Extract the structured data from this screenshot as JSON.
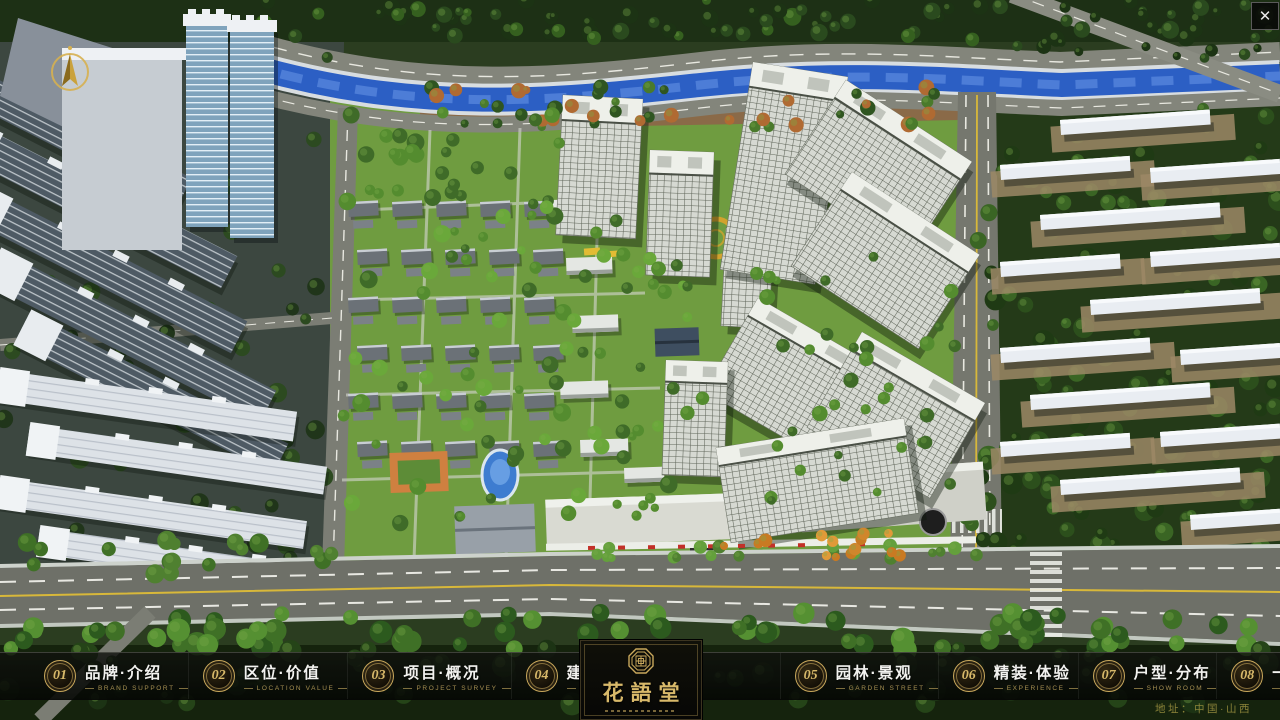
{
  "app": {
    "close_button": "✕"
  },
  "viewport": {
    "description": "aerial 3D masterplan render of residential development"
  },
  "nav": {
    "items": [
      {
        "number": "01",
        "title": "品牌·介绍",
        "subtitle": "BRAND SUPPORT"
      },
      {
        "number": "02",
        "title": "区位·价值",
        "subtitle": "LOCATION VALUE"
      },
      {
        "number": "03",
        "title": "项目·概况",
        "subtitle": "PROJECT SURVEY"
      },
      {
        "number": "04",
        "title": "建筑·鉴赏",
        "subtitle": "APPRECIATION"
      },
      {
        "number": "05",
        "title": "园林·景观",
        "subtitle": "GARDEN STREET"
      },
      {
        "number": "06",
        "title": "精装·体验",
        "subtitle": "EXPERIENCE"
      },
      {
        "number": "07",
        "title": "户型·分布",
        "subtitle": "SHOW ROOM"
      },
      {
        "number": "08",
        "title": "一房·一景",
        "subtitle": "COMMUNITY"
      }
    ],
    "logo": {
      "title": "花語堂"
    }
  },
  "footer": {
    "address": "地址：中国·山西"
  },
  "colors": {
    "gold_accent": "#c9a85c",
    "bar_background": "#0a0c08",
    "river_blue": "#2c5fc4",
    "grass_green": "#6f9c40"
  }
}
